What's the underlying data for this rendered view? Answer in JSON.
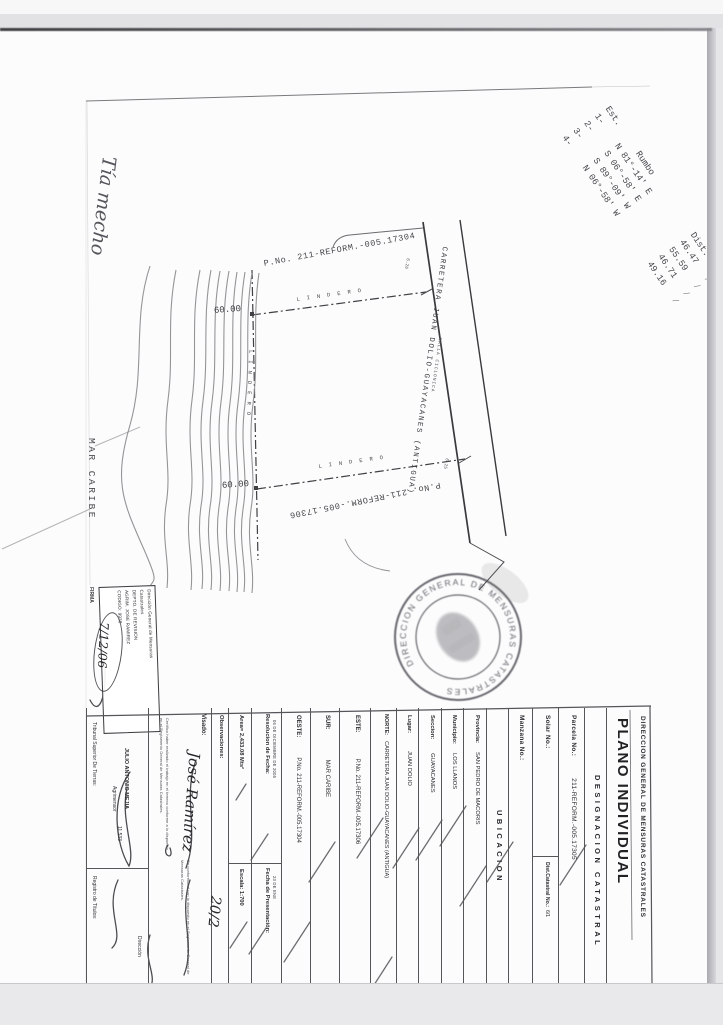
{
  "bearing_table": {
    "headers": [
      "Est.",
      "Rumbo",
      "Dist."
    ],
    "rows": [
      [
        "1-",
        "N 81°-14' E",
        "46.47"
      ],
      [
        "2-",
        "S 06°-58' E",
        "55.59"
      ],
      [
        "3-",
        "S 89°-09' W",
        "46.71"
      ],
      [
        "4-",
        "N 06°-58' W",
        "49.16"
      ]
    ]
  },
  "annotations": {
    "handwritten_top": "Tía mecho",
    "firma_date": "7/12/06",
    "visado_signature": "José Ramírez",
    "visado_date": "20/2"
  },
  "drawing": {
    "sea_label": "MAR CARIBE",
    "road_label": "CARRETERA JUAN DOLIO-GUAYACANES (ANTIGUA)",
    "fence_label": "MALLA CICLONICA",
    "boundary_label_top": "LINDERO",
    "boundary_label_bottom": "LINDERO",
    "boundary_label_left": "LINDERO",
    "north_parcel": "P.No. 211-REFORM.-005.17304",
    "south_parcel": "P.No. 211-REFORM.-005.17306",
    "dim_top": "60.00",
    "dim_bottom": "60.00",
    "tick_top": "6.26",
    "tick_bottom": "6.25"
  },
  "stamp": {
    "text": "DIRECCION GENERAL DE MENSURAS CATASTRALES"
  },
  "revision_box": {
    "line1": "Dirección General de Mensuras",
    "line2": "Catastrales",
    "line3": "DEPTO. DE REVISION",
    "line4": "AGRIM. JOSE RAMIREZ",
    "line5": "CODIGO: 9938",
    "firma_label": "FIRMA"
  },
  "form": {
    "dept": "DIRECCION GENERAL DE MENSURAS CATASTRALES",
    "title": "PLANO INDIVIDUAL",
    "designacion_header": "DESIGNACION CATASTRAL",
    "parcela_label": "Parcela No.:",
    "parcela_value": "211-REFORM.-005.17305",
    "solar_label": "Solar No.:",
    "dist_catastral_label": "Dist.Catastral No.:",
    "dist_catastral_value": "6/1",
    "manzana_label": "Manzana No.:",
    "ubicacion_header": "UBICACION",
    "provincia_label": "Provincia:",
    "provincia_value": "SAN PEDRO DE MACORIS",
    "municipio_label": "Municipio:",
    "municipio_value": "LOS LLANOS",
    "seccion_label": "Seccion:",
    "seccion_value": "GUAYACANES",
    "lugar_label": "Lugar:",
    "lugar_value": "JUAN DOLIO",
    "norte_label": "NORTE:",
    "norte_value": "CARRETERA JUAN DOLIO-GUAYACANES (ANTIGUA)",
    "este_label": "ESTE:",
    "este_value": "P.No. 211-REFORM.-005.17306",
    "sur_label": "SUR:",
    "sur_value": "MAR CARIBE",
    "oeste_label": "OESTE:",
    "oeste_value": "P.No. 211-REFORM.-005.17304",
    "resolucion_label": "Resolucion de Fecha:",
    "resolucion_value": "06 DE DICIEMBRE DE 2005",
    "fecha_pres_label": "Fecha de Presentación:",
    "fecha_pres_value": "23 DE ENE",
    "area_label": "Area= 2,433.08 Mts²",
    "escala_label": "Escala: 1:700",
    "observaciones_label": "Observaciones:",
    "visado_label": "Visado:",
    "cert_left": "Certifico haber realizado el trabajo en el terreno conforme a lo dispuesto en el Reglamento General de Mensuras Catastrales.",
    "cert_right": "De conformidad con lo dispuesto en el Reglamento General de Mensuras Catastrales.",
    "tribunal_label": "Tribunal Superior De Tierras:",
    "agrimensor_name": "JULIO ANTONIO MEJIA",
    "agrimensor_title": "Agrimensor",
    "agrimensor_code": "11,533",
    "registro_label": "Registro de Títulos:",
    "direccion_label": "Dirección"
  }
}
